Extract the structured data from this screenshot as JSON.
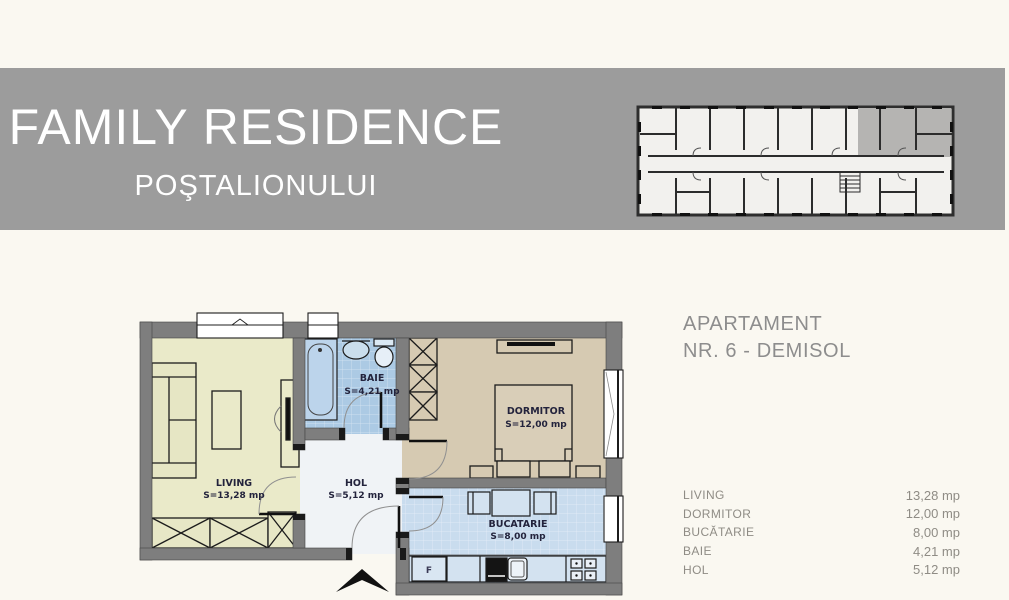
{
  "banner": {
    "title": "FAMILY RESIDENCE",
    "subtitle": "POŞTALIONULUI",
    "bg_color": "#9c9c9c",
    "text_color": "#ffffff"
  },
  "apartment": {
    "heading_line1": "APARTAMENT",
    "heading_line2": "NR. 6 - DEMISOL"
  },
  "rooms_table": {
    "rows": [
      {
        "label": "LIVING",
        "value": "13,28 mp"
      },
      {
        "label": "DORMITOR",
        "value": "12,00 mp"
      },
      {
        "label": "BUCĂTARIE",
        "value": "8,00 mp"
      },
      {
        "label": "BAIE",
        "value": "4,21 mp"
      },
      {
        "label": "HOL",
        "value": "5,12 mp"
      }
    ]
  },
  "floor_plan": {
    "rooms": [
      {
        "name": "LIVING",
        "area": "S=13,28 mp"
      },
      {
        "name": "BAIE",
        "area": "S=4,21 mp"
      },
      {
        "name": "HOL",
        "area": "S=5,12 mp"
      },
      {
        "name": "DORMITOR",
        "area": "S=12,00 mp"
      },
      {
        "name": "BUCATARIE",
        "area": "S=8,00 mp"
      }
    ],
    "fridge_label": "F",
    "colors": {
      "wall": "#7e7e7e",
      "living": "#eaeac9",
      "baie": "#accae4",
      "hol": "#f0f3f6",
      "dormitor": "#d6cab2",
      "bucatarie": "#c9dcee",
      "page_bg": "#faf8f1",
      "mini_plan_highlight": "#b5b4b2"
    }
  }
}
